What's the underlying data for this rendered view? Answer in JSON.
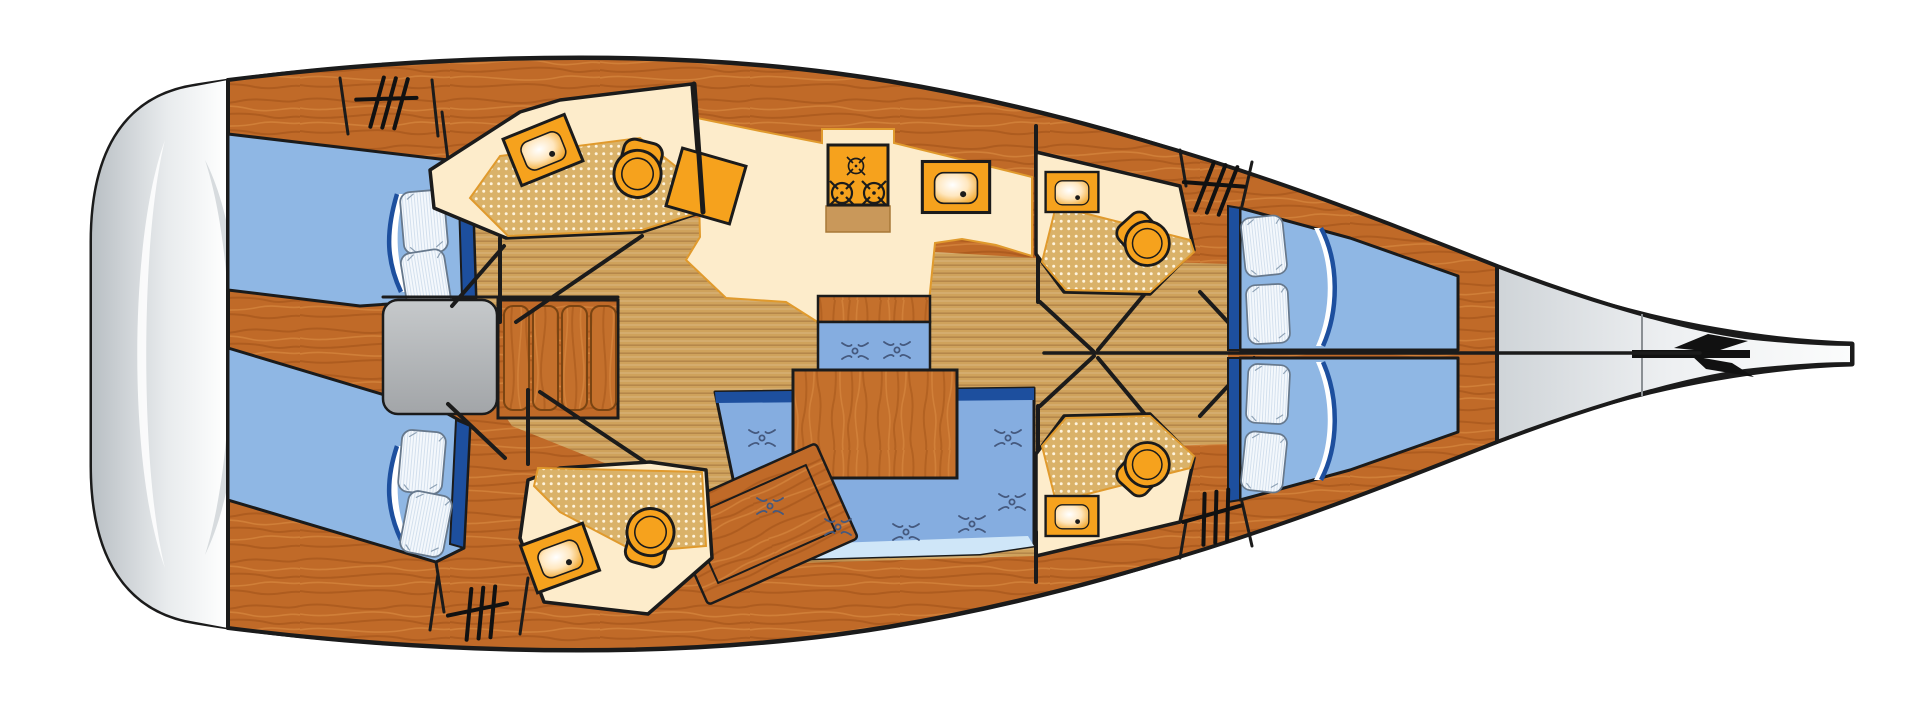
{
  "diagram": {
    "type": "yacht-floorplan-top-view",
    "orientation": {
      "bow": "right",
      "stern": "left"
    },
    "colors": {
      "outline": "#1b1b1b",
      "wood": "#c06a28",
      "wood_dark": "#a5551a",
      "wood_light": "#d8883f",
      "sole_tan": "#cfa25c",
      "cream": "#fdeccb",
      "shower_tan": "#dab269",
      "fixture_orange": "#f6a21d",
      "mattress_blue": "#8fb7e4",
      "mattress_edge_blue": "#1d4f9e",
      "sofa_blue": "#85ade0",
      "sofa_trim_pale": "#cfe6f8",
      "pillow_white": "#f2f7fc",
      "engine_box_gray": "#b3b6b8",
      "hull_gray": "#c4c9cd",
      "hull_white": "#ffffff"
    },
    "rooms": [
      {
        "id": "aft-cabin-port",
        "furniture": [
          "double-berth",
          "pillow",
          "pillow",
          "deck-hatch"
        ]
      },
      {
        "id": "aft-head-port",
        "furniture": [
          "washbasin",
          "toilet",
          "shower-floor"
        ]
      },
      {
        "id": "galley",
        "furniture": [
          "three-burner-stove",
          "sink",
          "worktop"
        ]
      },
      {
        "id": "salon",
        "furniture": [
          "u-shaped-sofa",
          "dining-table",
          "bench-seat",
          "chart-table"
        ]
      },
      {
        "id": "companionway",
        "furniture": [
          "engine-box",
          "steps"
        ]
      },
      {
        "id": "aft-cabin-starboard",
        "furniture": [
          "double-berth",
          "pillow",
          "pillow",
          "deck-hatch"
        ]
      },
      {
        "id": "aft-head-starboard",
        "furniture": [
          "washbasin",
          "toilet",
          "shower-floor"
        ]
      },
      {
        "id": "fwd-head-port",
        "furniture": [
          "washbasin",
          "toilet",
          "shower-floor"
        ]
      },
      {
        "id": "fwd-head-starboard",
        "furniture": [
          "washbasin",
          "toilet",
          "shower-floor"
        ]
      },
      {
        "id": "forward-cabin",
        "furniture": [
          "v-berth-port",
          "v-berth-starboard",
          "pillow",
          "pillow",
          "pillow",
          "pillow",
          "deck-hatch",
          "deck-hatch"
        ]
      }
    ],
    "exterior": {
      "stern": "swim-platform",
      "bow": "bow-taper-with-windlass-emblem"
    },
    "counts": {
      "cabins": 3,
      "heads": 4,
      "berths": 4,
      "pillows": 8,
      "deck_hatches": 4,
      "companionway_steps": 4,
      "stove_burners": 3,
      "upholstery_buttons": 9
    }
  }
}
